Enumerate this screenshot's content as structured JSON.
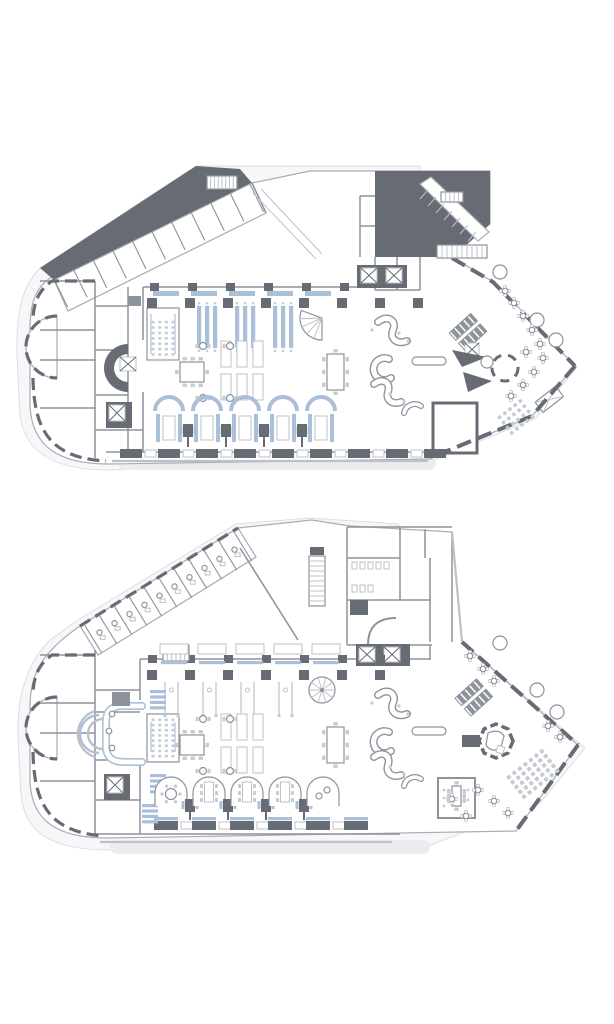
{
  "canvas": {
    "width": 614,
    "height": 1024,
    "background": "#ffffff"
  },
  "palette": {
    "floor": "#ffffff",
    "site_fill": "#f7f7f9",
    "site_stroke": "#dcdee3",
    "silhouette_stroke": "#a7adb5",
    "wall_dark": "#676c74",
    "wall_mid": "#8d939b",
    "wall_light": "#bcc1c8",
    "shadow": "#ececef",
    "shadow_soft": "#f0f1f4",
    "shadow_faint": "#f5f6f8",
    "accent_blue": "#a9c0d8",
    "seat_fill": "#c7ccd3"
  },
  "plans": [
    {
      "id": "plan-top",
      "label": "upper-level-floor-plan"
    },
    {
      "id": "plan-bottom",
      "label": "lower-level-floor-plan"
    }
  ],
  "generated": [
    {
      "type": "partitions",
      "g": "p1-wing",
      "x1": 54,
      "y1": 279,
      "x2": 250,
      "y2": 184,
      "n": 10,
      "depth": 31,
      "desks": false,
      "name": "wing-room-partition"
    },
    {
      "type": "ladder",
      "g": "p1-fix",
      "x": 207,
      "y": 176,
      "w": 30,
      "h": 13,
      "n": 8,
      "name": "courtyard-stair"
    },
    {
      "type": "ladder",
      "g": "p1-fix",
      "x": 441,
      "y": 192,
      "w": 22,
      "h": 10,
      "n": 5,
      "name": "core-stair"
    },
    {
      "type": "ladder",
      "g": "p1-fix",
      "x": 437,
      "y": 245,
      "w": 50,
      "h": 13,
      "n": 10,
      "name": "core-stair"
    },
    {
      "type": "row",
      "g": "p1-walls",
      "x0": 150,
      "dx": 38,
      "n": 6,
      "y": 283,
      "w": 9,
      "h": 8,
      "color": "wall_dark",
      "name": "pilaster"
    },
    {
      "type": "row",
      "g": "p1-fix",
      "x0": 153,
      "dx": 38,
      "n": 5,
      "y": 291,
      "w": 26,
      "h": 5,
      "color": "accent_blue",
      "name": "banquette"
    },
    {
      "type": "row",
      "g": "p1-cols",
      "xs": [
        152,
        190,
        228,
        266,
        304,
        342,
        380,
        418
      ],
      "y": 298,
      "w": 10,
      "h": 10,
      "color": "wall_dark",
      "name": "column"
    },
    {
      "type": "benches",
      "g": "p1-fur",
      "bays": [
        190,
        228,
        266
      ],
      "offsets": [
        7,
        15,
        23
      ],
      "y": 306,
      "w": 4.2,
      "h": 42,
      "name": "dining-bench"
    },
    {
      "type": "grid",
      "g": "p1-fur",
      "cx": 163,
      "cy": 341,
      "cols": 4,
      "rows": 8,
      "dx": 6.6,
      "dy": 5.4,
      "w": 3.2,
      "h": 2.6,
      "rot": 0,
      "color": "seat_fill",
      "name": "meeting-seat"
    },
    {
      "type": "rects",
      "g": "p1-fur",
      "cls": "tbl",
      "items": [
        [
          221,
          341,
          10,
          26
        ],
        [
          237,
          341,
          10,
          26
        ],
        [
          253,
          341,
          10,
          26
        ],
        [
          221,
          374,
          10,
          26
        ],
        [
          237,
          374,
          10,
          26
        ],
        [
          253,
          374,
          10,
          26
        ]
      ],
      "name": "table"
    },
    {
      "type": "chairsH",
      "g": "p1-fur",
      "x": 180,
      "y": 362,
      "w": 24,
      "h": 20,
      "name": "chair"
    },
    {
      "type": "chairsV",
      "g": "p1-fur",
      "x": 327,
      "y": 354,
      "w": 17,
      "h": 36,
      "name": "chair"
    },
    {
      "type": "pairTables",
      "g": "p1-fur",
      "pts": [
        [
          203,
          346
        ],
        [
          230,
          346
        ],
        [
          203,
          398
        ],
        [
          230,
          398
        ]
      ],
      "name": "cafe-table"
    },
    {
      "type": "booths",
      "g": "p1-fur",
      "centers": [
        169,
        207,
        245,
        283,
        321
      ],
      "baseY": 411,
      "name": "booth"
    },
    {
      "type": "bottomwall",
      "g": "p1-walls",
      "x0": 120,
      "dx": 38,
      "n": 9,
      "y": 449,
      "bw": 22,
      "bh": 9,
      "tw": 11,
      "blue": false,
      "name": "facade-pier"
    },
    {
      "type": "grid",
      "g": "p1-terr",
      "cx": 516,
      "cy": 417,
      "cols": 5,
      "rows": 4,
      "dx": 6.6,
      "dy": 6.6,
      "w": 3.6,
      "h": 3.6,
      "rot": -38,
      "color": "seat_fill",
      "name": "terrace-seat"
    },
    {
      "type": "circles",
      "g": "p1-terr",
      "pts": [
        [
          500,
          272
        ],
        [
          537,
          320
        ],
        [
          556,
          340
        ]
      ],
      "r": 7,
      "name": "tree"
    },
    {
      "type": "flowers",
      "g": "p1-terr",
      "pts": [
        [
          505,
          291
        ],
        [
          514,
          303
        ],
        [
          523,
          316
        ],
        [
          532,
          330
        ],
        [
          540,
          344
        ],
        [
          543,
          358
        ],
        [
          534,
          372
        ],
        [
          523,
          385
        ],
        [
          511,
          396
        ],
        [
          526,
          352
        ]
      ],
      "name": "terrace-table"
    },
    {
      "type": "dots",
      "g": "p1-fur",
      "pts": [
        [
          399,
          333
        ],
        [
          408,
          341
        ],
        [
          372,
          330
        ],
        [
          390,
          394
        ],
        [
          404,
          401
        ]
      ],
      "r": 1.6,
      "name": "stool"
    },
    {
      "type": "spokesFan",
      "g": "p1-fur",
      "cx": 322,
      "cy": 318,
      "r": 22,
      "a1": 90,
      "a2": 200,
      "n": 4,
      "name": "fan-stair"
    },
    {
      "type": "partitions",
      "g": "p2-wing",
      "x1": 84,
      "y1": 624,
      "x2": 234,
      "y2": 532,
      "n": 10,
      "depth": 34,
      "desks": true,
      "name": "office-partition"
    },
    {
      "type": "ladder",
      "g": "p2-fix",
      "x": 309,
      "y": 556,
      "w": 16,
      "h": 50,
      "n": 10,
      "vert": true,
      "name": "escalator"
    },
    {
      "type": "ladder",
      "g": "p2-fix",
      "x": 163,
      "y": 645,
      "w": 26,
      "h": 16,
      "n": 6,
      "name": "wing-stair"
    },
    {
      "type": "row",
      "g": "p2-walls",
      "x0": 148,
      "dx": 38,
      "n": 7,
      "y": 655,
      "w": 9,
      "h": 8,
      "color": "wall_dark",
      "name": "pilaster"
    },
    {
      "type": "stripsRow",
      "g": "p2-fix",
      "x0": 160,
      "dx": 38,
      "n": 5,
      "yT": 644,
      "yS": 661,
      "w": 28,
      "name": "wall-table"
    },
    {
      "type": "row",
      "g": "p2-cols",
      "xs": [
        152,
        190,
        228,
        266,
        304,
        342,
        380
      ],
      "y": 670,
      "w": 10,
      "h": 10,
      "color": "wall_dark",
      "name": "column"
    },
    {
      "type": "thinTables",
      "g": "p2-fur",
      "bays": [
        152,
        190,
        228,
        266
      ],
      "y1": 682,
      "y2": 714,
      "name": "high-table"
    },
    {
      "type": "grid",
      "g": "p2-fur",
      "cx": 163,
      "cy": 738,
      "cols": 4,
      "rows": 8,
      "dx": 6.6,
      "dy": 5.2,
      "w": 3.2,
      "h": 2.6,
      "rot": 0,
      "color": "seat_fill",
      "name": "seat"
    },
    {
      "type": "combs",
      "g": "p2-fur",
      "spots": [
        [
          150,
          690
        ],
        [
          150,
          774
        ],
        [
          142,
          804
        ]
      ],
      "bars": 4,
      "w": 16,
      "h": 3.2,
      "gap": 2.2,
      "name": "shelf"
    },
    {
      "type": "rects",
      "g": "p2-fur",
      "cls": "tbl",
      "items": [
        [
          221,
          714,
          10,
          26
        ],
        [
          237,
          714,
          10,
          26
        ],
        [
          253,
          714,
          10,
          26
        ],
        [
          221,
          747,
          10,
          26
        ],
        [
          237,
          747,
          10,
          26
        ],
        [
          253,
          747,
          10,
          26
        ]
      ],
      "name": "table"
    },
    {
      "type": "chairsH",
      "g": "p2-fur",
      "x": 180,
      "y": 735,
      "w": 24,
      "h": 20,
      "name": "chair"
    },
    {
      "type": "chairsV",
      "g": "p2-fur",
      "x": 327,
      "y": 727,
      "w": 17,
      "h": 36,
      "name": "chair"
    },
    {
      "type": "pairTables",
      "g": "p2-fur",
      "pts": [
        [
          203,
          719
        ],
        [
          230,
          719
        ],
        [
          203,
          771
        ],
        [
          230,
          771
        ]
      ],
      "name": "cafe-table"
    },
    {
      "type": "arches",
      "g": "p2-fur",
      "centers": [
        171,
        209,
        247,
        285,
        323
      ],
      "baseY": 806,
      "name": "alcove-booth"
    },
    {
      "type": "bottomwall",
      "g": "p2-walls",
      "x0": 154,
      "dx": 38,
      "n": 6,
      "y": 821,
      "bw": 24,
      "bh": 9,
      "tw": 12,
      "blue": true,
      "name": "facade-pier"
    },
    {
      "type": "grid",
      "g": "p2-terr",
      "cx": 533,
      "cy": 774,
      "cols": 7,
      "rows": 5,
      "dx": 7,
      "dy": 6.2,
      "w": 4,
      "h": 4,
      "rot": -38,
      "color": "seat_fill",
      "name": "terrace-seat"
    },
    {
      "type": "circles",
      "g": "p2-terr",
      "pts": [
        [
          500,
          643
        ],
        [
          537,
          690
        ],
        [
          557,
          712
        ]
      ],
      "r": 7,
      "name": "tree"
    },
    {
      "type": "flowers",
      "g": "p2-terr",
      "pts": [
        [
          470,
          656
        ],
        [
          483,
          669
        ],
        [
          494,
          681
        ],
        [
          548,
          726
        ],
        [
          560,
          737
        ],
        [
          478,
          790
        ],
        [
          494,
          801
        ],
        [
          508,
          813
        ],
        [
          466,
          816
        ],
        [
          452,
          799
        ]
      ],
      "name": "terrace-table"
    },
    {
      "type": "circles",
      "g": "p2-fur",
      "pts": [
        [
          112,
          714
        ],
        [
          109,
          731
        ],
        [
          112,
          748
        ]
      ],
      "r": 2.8,
      "name": "stool"
    },
    {
      "type": "spokes",
      "g": "p2-fur",
      "cx": 322,
      "cy": 690,
      "r": 13,
      "n": 10,
      "name": "spiral-stair"
    },
    {
      "type": "dots",
      "g": "p2-fur",
      "pts": [
        [
          399,
          706
        ],
        [
          408,
          714
        ],
        [
          372,
          703
        ],
        [
          390,
          767
        ],
        [
          404,
          774
        ]
      ],
      "r": 1.6,
      "name": "stool"
    },
    {
      "type": "dots",
      "g": "p2-terr",
      "pts": [
        [
          444,
          790
        ],
        [
          444,
          798
        ],
        [
          444,
          806
        ],
        [
          468,
          790
        ],
        [
          468,
          800
        ]
      ],
      "r": 1.4,
      "name": "seat-dot"
    },
    {
      "type": "rects",
      "g": "p2-core",
      "cls": "tbl",
      "items": [
        [
          352,
          562,
          5,
          7
        ],
        [
          360,
          562,
          5,
          7
        ],
        [
          368,
          562,
          5,
          7
        ],
        [
          376,
          562,
          5,
          7
        ],
        [
          384,
          562,
          5,
          7
        ],
        [
          352,
          585,
          5,
          7
        ],
        [
          360,
          585,
          5,
          7
        ],
        [
          368,
          585,
          5,
          7
        ]
      ],
      "name": "fixture"
    },
    {
      "type": "chairsV",
      "g": "p2-terr",
      "x": 452,
      "y": 786,
      "w": 9,
      "h": 20,
      "name": "chair"
    }
  ]
}
